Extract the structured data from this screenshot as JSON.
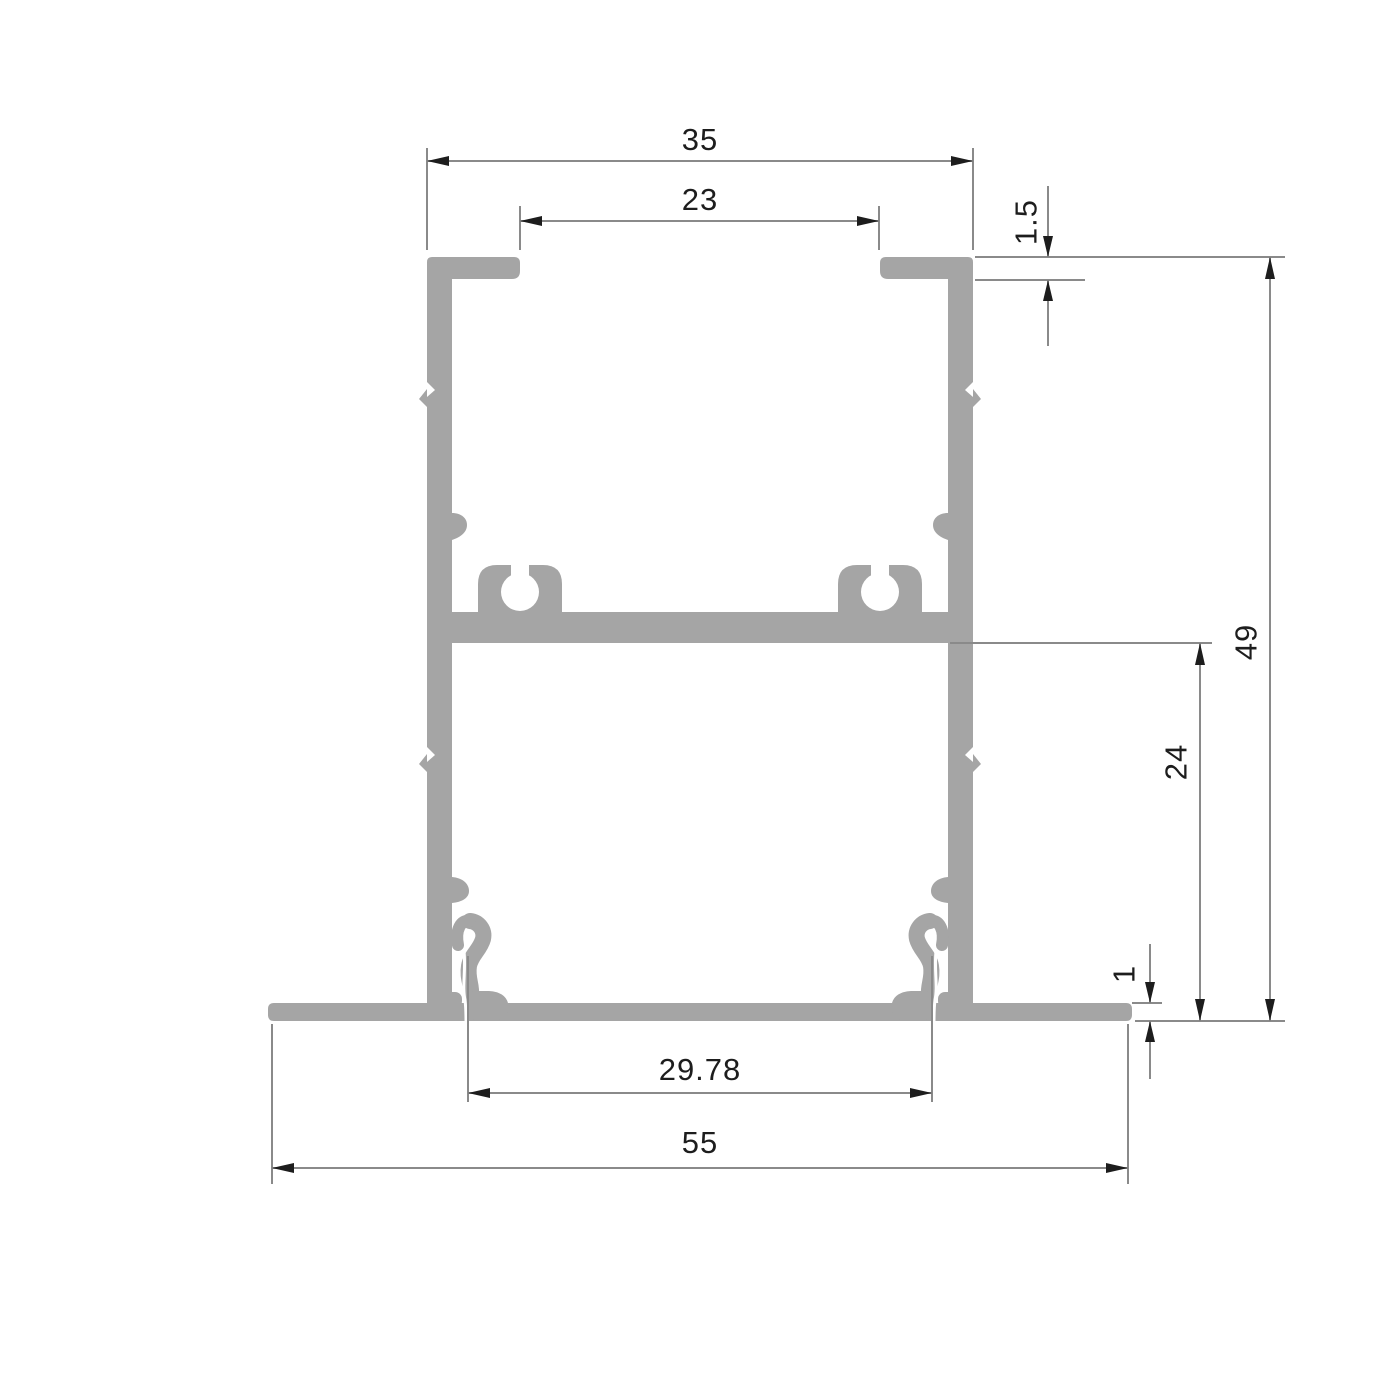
{
  "drawing": {
    "title": "aluminium-profile-cross-section",
    "background_color": "#ffffff",
    "profile_color": "#a5a5a5",
    "dimension_line_color": "#8a8a8a",
    "arrow_color": "#1d1d1d",
    "text_color": "#1d1d1d",
    "dimensions": [
      {
        "id": "top-outer-width",
        "label": "35",
        "orientation": "horizontal"
      },
      {
        "id": "top-opening-width",
        "label": "23",
        "orientation": "horizontal"
      },
      {
        "id": "top-flange-thickness",
        "label": "1.5",
        "orientation": "vertical"
      },
      {
        "id": "overall-height",
        "label": "49",
        "orientation": "vertical"
      },
      {
        "id": "lower-chamber-height",
        "label": "24",
        "orientation": "vertical"
      },
      {
        "id": "base-flange-thickness",
        "label": "1",
        "orientation": "vertical"
      },
      {
        "id": "bottom-opening-width",
        "label": "29.78",
        "orientation": "horizontal"
      },
      {
        "id": "overall-width",
        "label": "55",
        "orientation": "horizontal"
      }
    ]
  }
}
